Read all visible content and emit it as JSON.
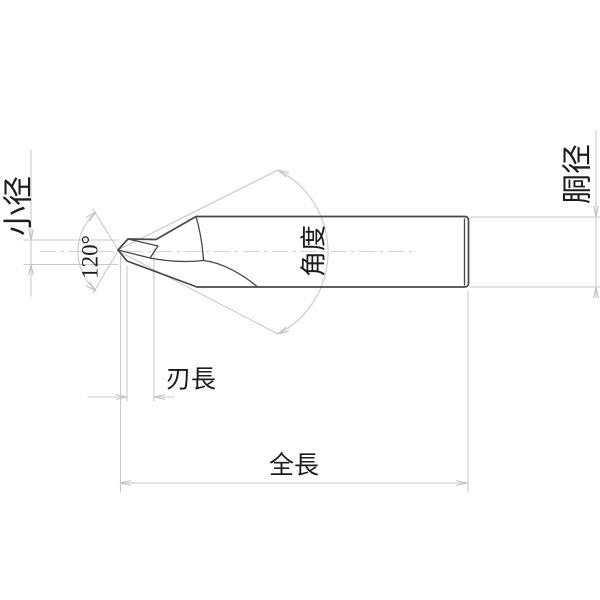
{
  "drawing": {
    "subject": "center-drill-side-view-technical-drawing",
    "labels": {
      "small_diameter": "小径",
      "point_angle": "120°",
      "taper_angle": "角度",
      "body_diameter": "胴径",
      "flute_length": "刃長",
      "overall_length": "全長"
    },
    "colors": {
      "background": "#ffffff",
      "part_outline": "#474747",
      "dimension_lines": "#c9c9c9",
      "label_text": "#1c1c1c"
    }
  }
}
